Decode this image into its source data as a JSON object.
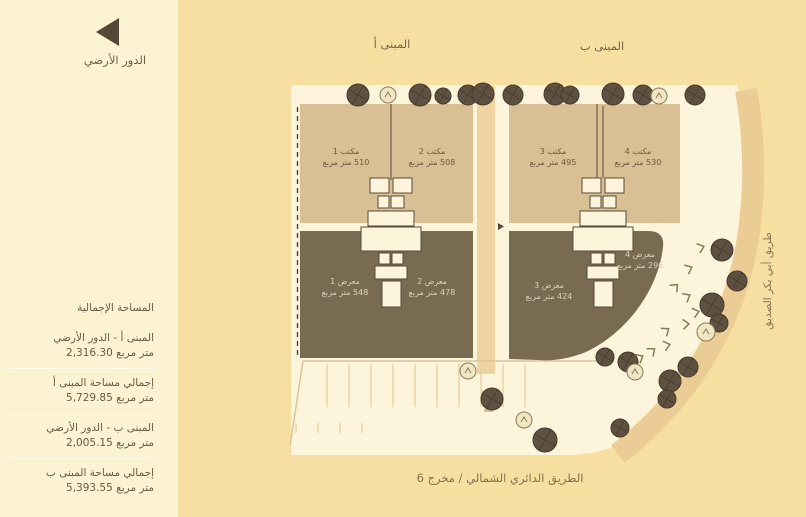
{
  "title": "الدور الأرضي",
  "colors": {
    "background": "#F6DFA1",
    "panel": "#FBF3D2",
    "plot": "#FCF5DB",
    "office_fill": "#D9BF94",
    "showroom_fill": "#796B52",
    "tree": "#5E5140",
    "road_band": "#ECCC95"
  },
  "legend": {
    "floor_label": "الدور الأرضي"
  },
  "summary": {
    "header": "المساحة الإجمالية",
    "stats": [
      {
        "label": "المبنى أ - الدور الأرضي",
        "value": "2,316.30 متر مربع"
      },
      {
        "label": "إجمالي مساحة المبنى أ",
        "value": "5,729.85 متر مربع"
      },
      {
        "label": "المبنى ب - الدور الأرضي",
        "value": "2,005.15 متر مربع"
      },
      {
        "label": "إجمالي مساحة المبنى ب",
        "value": "5,393.55 متر مربع"
      }
    ]
  },
  "plan": {
    "building_a_label": "المبنى أ",
    "building_b_label": "المبنى ب",
    "units": [
      {
        "name": "مكتب 1",
        "area": "510 متر مربع"
      },
      {
        "name": "مكتب 2",
        "area": "508 متر مربع"
      },
      {
        "name": "مكتب 3",
        "area": "495 متر مربع"
      },
      {
        "name": "مكتب 4",
        "area": "530 متر مربع"
      },
      {
        "name": "معرض 1",
        "area": "548 متر مربع"
      },
      {
        "name": "معرض 2",
        "area": "478 متر مربع"
      },
      {
        "name": "معرض 3",
        "area": "424 متر مربع"
      },
      {
        "name": "معرض 4",
        "area": "296 متر مربع"
      }
    ],
    "roads": {
      "bottom": "الطريق الدائري الشمالي / مخرج 6",
      "right": "طريق أبي بكر الصديق"
    }
  }
}
